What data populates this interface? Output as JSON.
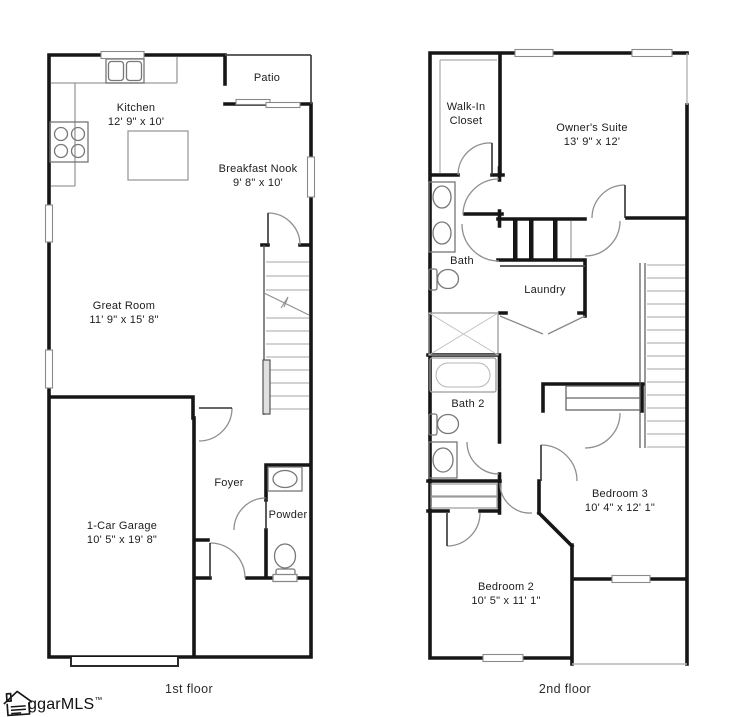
{
  "floors": [
    {
      "caption": "1st floor",
      "rooms": [
        {
          "name": "Kitchen",
          "dims": "12' 9\" x 10'"
        },
        {
          "name": "Patio",
          "dims": ""
        },
        {
          "name": "Breakfast Nook",
          "dims": "9' 8\" x 10'"
        },
        {
          "name": "Great Room",
          "dims": "11' 9\" x 15' 8\""
        },
        {
          "name": "Foyer",
          "dims": ""
        },
        {
          "name": "Powder",
          "dims": ""
        },
        {
          "name": "1-Car Garage",
          "dims": "10' 5\" x 19' 8\""
        }
      ]
    },
    {
      "caption": "2nd floor",
      "rooms": [
        {
          "name": "Walk-In Closet",
          "dims": ""
        },
        {
          "name": "Owner's Suite",
          "dims": "13' 9\" x 12'"
        },
        {
          "name": "Bath",
          "dims": ""
        },
        {
          "name": "Laundry",
          "dims": ""
        },
        {
          "name": "Bath 2",
          "dims": ""
        },
        {
          "name": "Bedroom 3",
          "dims": "10' 4\" x 12' 1\""
        },
        {
          "name": "Bedroom 2",
          "dims": "10' 5\" x 11' 1\""
        }
      ]
    }
  ],
  "logo": {
    "text": "ggarMLS",
    "tm": "™",
    "icon": "house-icon"
  },
  "colors": {
    "wall": "#161616",
    "medium": "#4a4a4a",
    "thin": "#9a9a9a",
    "light": "#bdbdbd",
    "text": "#1c1c1c"
  }
}
